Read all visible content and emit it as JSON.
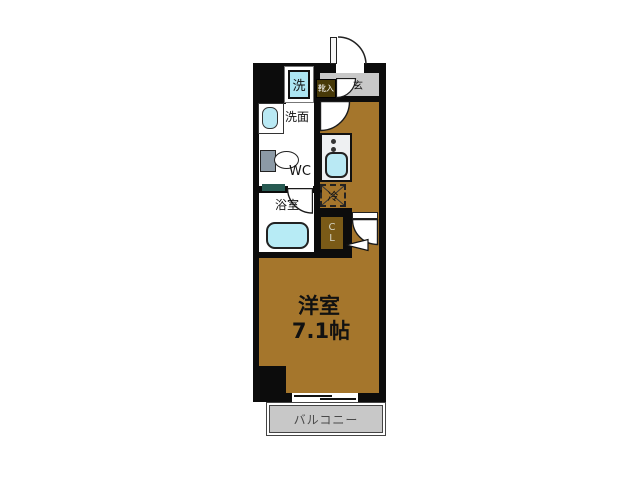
{
  "plan": {
    "type": "apartment-floorplan",
    "colors": {
      "wall": "#0c0c0c",
      "wood_floor": "#a5762c",
      "entrance_floor": "#c8c8c8",
      "balcony_floor": "#c8c8c8",
      "fixture_blue": "#b9e9f4",
      "closet_brown": "#7a5a17",
      "shoebox_brown": "#473908",
      "counter_teal": "#275a52"
    },
    "rooms": {
      "main_room": {
        "name": "洋室",
        "size": "7.1帖"
      },
      "balcony": {
        "label": "バルコニー"
      },
      "entrance": {
        "label": "玄",
        "shoe_cabinet": "靴入"
      },
      "washroom": {
        "label": "洗面"
      },
      "toilet": {
        "label": "WC"
      },
      "bathroom": {
        "label": "浴室"
      },
      "laundry": {
        "label": "洗"
      },
      "refrigerator": {
        "label": "冷"
      },
      "closet": {
        "line1": "C",
        "line2": "L"
      }
    }
  }
}
